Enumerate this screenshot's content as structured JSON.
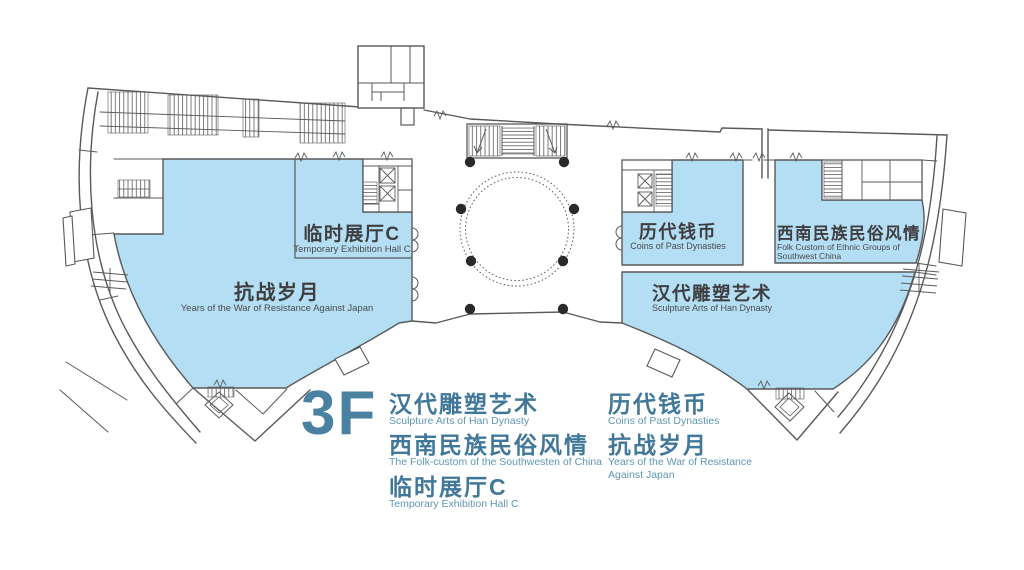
{
  "floor": {
    "label": "3F"
  },
  "colors": {
    "room_fill": "#b4def3",
    "wall_line": "#58595b",
    "plan_text_zh": "#3e3e40",
    "plan_text_en": "#4a4b4d",
    "legend_text_zh": "#41789a",
    "legend_text_en": "#5f97b0",
    "floor_label": "#4a81a0",
    "dot": "#2a2a2c"
  },
  "plan_labels": {
    "temporary_hall_c": {
      "zh": "临时展厅C",
      "en": "Temporary Exhibition Hall C"
    },
    "war_years": {
      "zh": "抗战岁月",
      "en": "Years of the War of Resistance Against Japan"
    },
    "coins": {
      "zh": "历代钱币",
      "en": "Coins of Past Dynasties"
    },
    "folk_custom": {
      "zh": "西南民族民俗风情",
      "en_line1": "Folk Custom of Ethnic Groups of",
      "en_line2": "Southwest China"
    },
    "han_sculpture": {
      "zh": "汉代雕塑艺术",
      "en": "Sculpture Arts of Han Dynasty"
    }
  },
  "legend": {
    "floor_label": "3F",
    "column1": [
      {
        "zh": "汉代雕塑艺术",
        "en": "Sculpture Arts of Han Dynasty"
      },
      {
        "zh": "西南民族民俗风情",
        "en": "The Folk-custom of the Southwesten of China"
      },
      {
        "zh": "临时展厅C",
        "en": "Temporary Exhibition Hall C"
      }
    ],
    "column2": [
      {
        "zh": "历代钱币",
        "en": "Coins of Past Dynasties"
      },
      {
        "zh": "抗战岁月",
        "en": "Years of the War of Resistance",
        "en2": "Against Japan"
      }
    ]
  }
}
